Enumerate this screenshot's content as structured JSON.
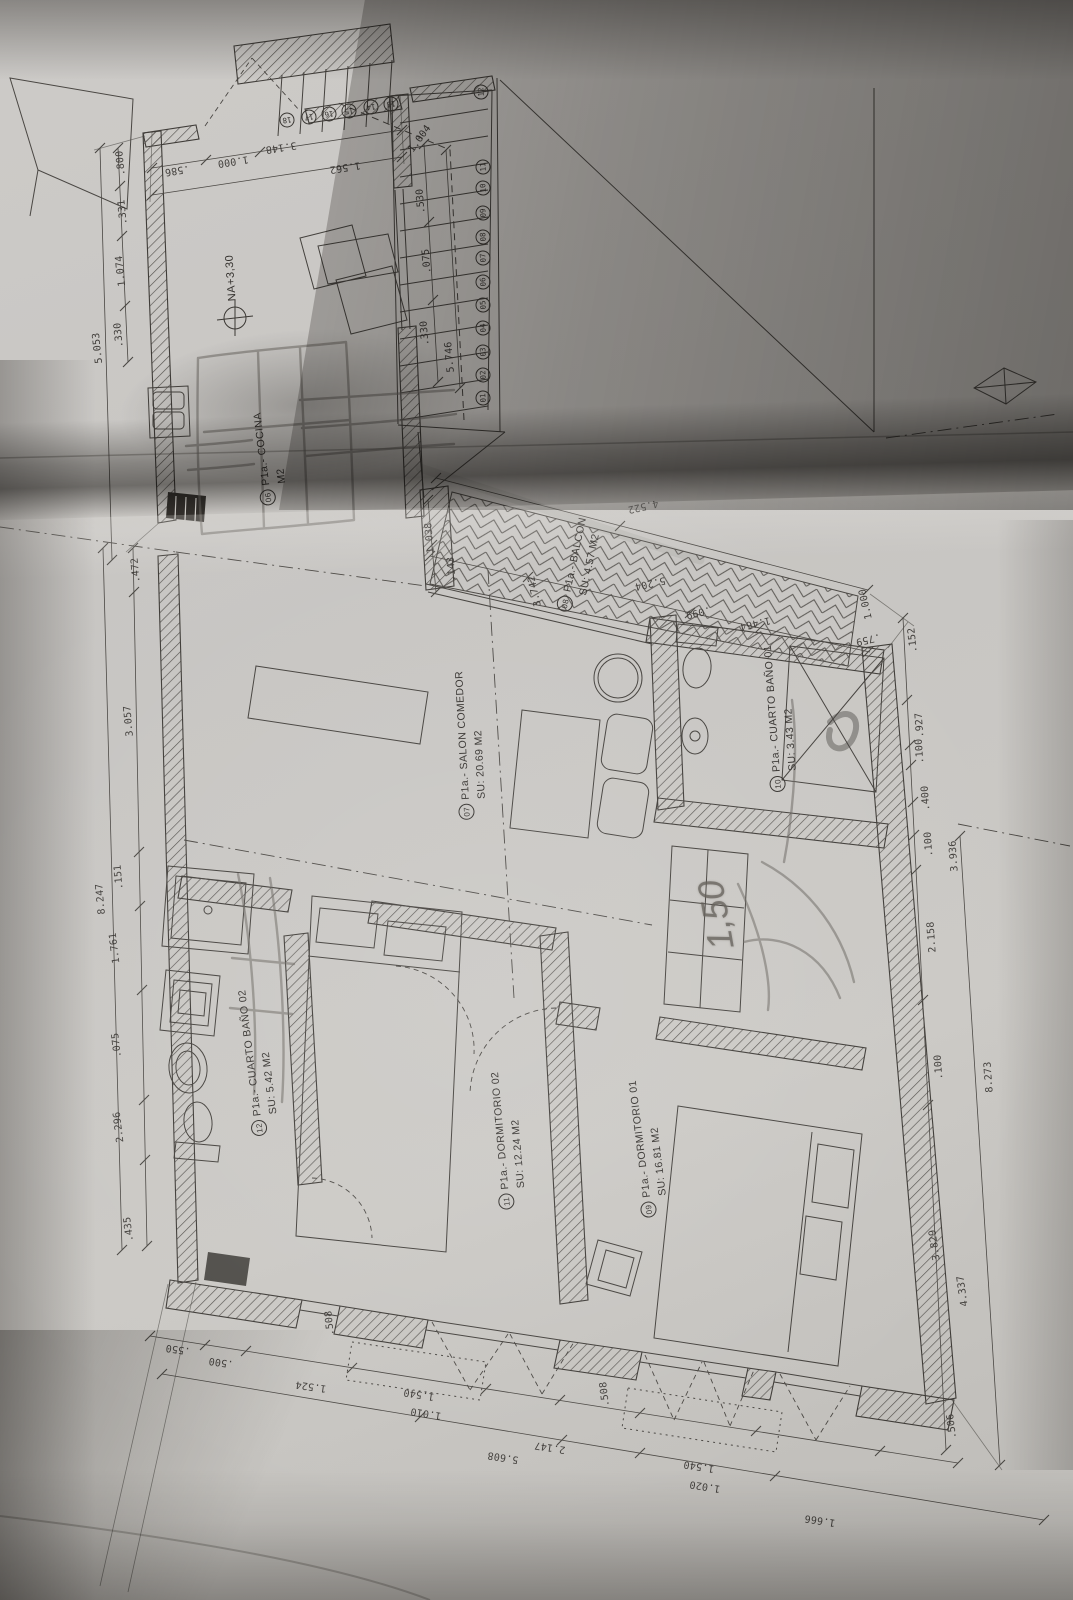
{
  "plan": {
    "rooms": [
      {
        "circled": "06",
        "name": "P1a.- COCINA",
        "area": "M2",
        "x": 270,
        "y": 458,
        "rot": -97
      },
      {
        "circled": "07",
        "name": "P1a.- SALON COMEDOR",
        "area": "SU: 20.69 M2",
        "x": 470,
        "y": 745,
        "rot": -93
      },
      {
        "circled": "08",
        "name": "P1a.- BALCON",
        "area": "SU: 4.57 M2",
        "x": 580,
        "y": 566,
        "rot": -78
      },
      {
        "circled": "09",
        "name": "P1a.- DORMITORIO 01",
        "area": "SU: 16.81 M2",
        "x": 648,
        "y": 1148,
        "rot": -97
      },
      {
        "circled": "10",
        "name": "P1a.- CUARTO BAÑO 01",
        "area": "SU: 3.43 M2",
        "x": 780,
        "y": 718,
        "rot": -94
      },
      {
        "circled": "11",
        "name": "P1a.- DORMITORIO 02",
        "area": "SU: 12.24 M2",
        "x": 508,
        "y": 1140,
        "rot": -95
      },
      {
        "circled": "12",
        "name": "P1a.- CUARTO BAÑO 02",
        "area": "SU: 5.42 M2",
        "x": 258,
        "y": 1062,
        "rot": -97
      }
    ],
    "level_marker": {
      "text": "NA+3,30"
    },
    "handwritten": {
      "text": "1,50"
    },
    "stair_numbers": [
      {
        "n": "01",
        "x": 483,
        "y": 398,
        "r": -95
      },
      {
        "n": "02",
        "x": 483,
        "y": 375,
        "r": -95
      },
      {
        "n": "03",
        "x": 483,
        "y": 352,
        "r": -95
      },
      {
        "n": "04",
        "x": 483,
        "y": 328,
        "r": -95
      },
      {
        "n": "05",
        "x": 483,
        "y": 305,
        "r": -95
      },
      {
        "n": "06",
        "x": 483,
        "y": 282,
        "r": -95
      },
      {
        "n": "07",
        "x": 483,
        "y": 258,
        "r": -95
      },
      {
        "n": "08",
        "x": 483,
        "y": 237,
        "r": -95
      },
      {
        "n": "09",
        "x": 483,
        "y": 213,
        "r": -95
      },
      {
        "n": "10",
        "x": 483,
        "y": 188,
        "r": -95
      },
      {
        "n": "11",
        "x": 483,
        "y": 167,
        "r": -95
      },
      {
        "n": "12",
        "x": 481,
        "y": 92,
        "r": -95
      },
      {
        "n": "13",
        "x": 391,
        "y": 104,
        "r": 171
      },
      {
        "n": "14",
        "x": 371,
        "y": 107,
        "r": 171
      },
      {
        "n": "15",
        "x": 349,
        "y": 111,
        "r": 171
      },
      {
        "n": "16",
        "x": 329,
        "y": 114,
        "r": 171
      },
      {
        "n": "17",
        "x": 309,
        "y": 117,
        "r": 171
      },
      {
        "n": "18",
        "x": 287,
        "y": 120,
        "r": 171
      }
    ],
    "dimensions": [
      {
        "t": ".586",
        "x": 177,
        "y": 170,
        "r": 171
      },
      {
        "t": "1.000",
        "x": 233,
        "y": 161,
        "r": 171
      },
      {
        "t": "3.148",
        "x": 281,
        "y": 147,
        "r": 171
      },
      {
        "t": "1.562",
        "x": 345,
        "y": 167,
        "r": 171
      },
      {
        "t": "1.004",
        "x": 420,
        "y": 139,
        "r": -54
      },
      {
        "t": ".530",
        "x": 421,
        "y": 201,
        "r": -95
      },
      {
        "t": ".075",
        "x": 427,
        "y": 261,
        "r": -95
      },
      {
        "t": ".330",
        "x": 425,
        "y": 333,
        "r": -95
      },
      {
        "t": "5.746",
        "x": 450,
        "y": 357,
        "r": -95
      },
      {
        "t": ".800",
        "x": 121,
        "y": 163,
        "r": -96
      },
      {
        "t": ".331",
        "x": 123,
        "y": 212,
        "r": -96
      },
      {
        "t": "1.074",
        "x": 121,
        "y": 271,
        "r": -96
      },
      {
        "t": ".330",
        "x": 119,
        "y": 335,
        "r": -96
      },
      {
        "t": "5.053",
        "x": 98,
        "y": 348,
        "r": -96
      },
      {
        "t": ".472",
        "x": 136,
        "y": 570,
        "r": -95
      },
      {
        "t": "3.057",
        "x": 129,
        "y": 721,
        "r": -95
      },
      {
        "t": ".151",
        "x": 119,
        "y": 877,
        "r": -95
      },
      {
        "t": "8.247",
        "x": 101,
        "y": 899,
        "r": -95
      },
      {
        "t": "1.761",
        "x": 115,
        "y": 948,
        "r": -97
      },
      {
        "t": ".075",
        "x": 117,
        "y": 1045,
        "r": -97
      },
      {
        "t": "2.296",
        "x": 119,
        "y": 1127,
        "r": -97
      },
      {
        "t": ".435",
        "x": 129,
        "y": 1229,
        "r": -97
      },
      {
        "t": "1.038",
        "x": 430,
        "y": 538,
        "r": -95
      },
      {
        "t": ".143",
        "x": 452,
        "y": 569,
        "r": -95
      },
      {
        "t": "4.522",
        "x": 643,
        "y": 506,
        "r": 167
      },
      {
        "t": "5.204",
        "x": 650,
        "y": 583,
        "r": 167
      },
      {
        "t": "3.742",
        "x": 535,
        "y": 591,
        "r": -103
      },
      {
        "t": ".099",
        "x": 698,
        "y": 612,
        "r": 167
      },
      {
        "t": "1.464",
        "x": 755,
        "y": 623,
        "r": 167
      },
      {
        "t": ".759",
        "x": 868,
        "y": 639,
        "r": 167
      },
      {
        "t": "1.000",
        "x": 866,
        "y": 604,
        "r": -103
      },
      {
        "t": ".152",
        "x": 913,
        "y": 640,
        "r": -96
      },
      {
        "t": ".927",
        "x": 920,
        "y": 725,
        "r": -94
      },
      {
        "t": ".100",
        "x": 920,
        "y": 751,
        "r": -94
      },
      {
        "t": ".400",
        "x": 926,
        "y": 798,
        "r": -94
      },
      {
        "t": ".100",
        "x": 929,
        "y": 844,
        "r": -94
      },
      {
        "t": "3.936",
        "x": 954,
        "y": 856,
        "r": -94
      },
      {
        "t": "2.158",
        "x": 932,
        "y": 937,
        "r": -94
      },
      {
        "t": ".100",
        "x": 939,
        "y": 1067,
        "r": -94
      },
      {
        "t": "8.273",
        "x": 989,
        "y": 1077,
        "r": -94
      },
      {
        "t": "3.829",
        "x": 935,
        "y": 1245,
        "r": -98
      },
      {
        "t": "4.337",
        "x": 963,
        "y": 1291,
        "r": -98
      },
      {
        "t": ".506",
        "x": 952,
        "y": 1426,
        "r": -97
      },
      {
        "t": ".550",
        "x": 178,
        "y": 1349,
        "r": 188
      },
      {
        "t": ".500",
        "x": 221,
        "y": 1362,
        "r": 188
      },
      {
        "t": "1.524",
        "x": 311,
        "y": 1386,
        "r": 188
      },
      {
        "t": ".508",
        "x": 330,
        "y": 1323,
        "r": -96
      },
      {
        "t": "1.540",
        "x": 419,
        "y": 1394,
        "r": 189
      },
      {
        "t": "1.010",
        "x": 426,
        "y": 1413,
        "r": 189
      },
      {
        "t": "5.608",
        "x": 503,
        "y": 1457,
        "r": 189
      },
      {
        "t": "2.147",
        "x": 550,
        "y": 1447,
        "r": 189
      },
      {
        "t": ".508",
        "x": 605,
        "y": 1394,
        "r": -97
      },
      {
        "t": "1.540",
        "x": 699,
        "y": 1466,
        "r": 189
      },
      {
        "t": "1.020",
        "x": 705,
        "y": 1486,
        "r": 189
      },
      {
        "t": "1.666",
        "x": 820,
        "y": 1520,
        "r": 189
      }
    ]
  },
  "colors": {
    "paper": "#c7c5c2",
    "line": "#43403c",
    "pencil": "#6b6763"
  }
}
